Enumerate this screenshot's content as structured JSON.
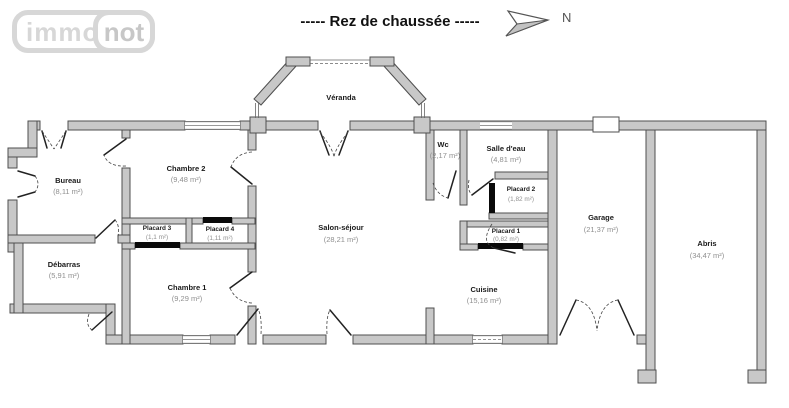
{
  "logo": {
    "immo": "immo",
    "not": "not"
  },
  "header": {
    "title": "-----  Rez de chaussée  -----",
    "north": "N"
  },
  "rooms": {
    "veranda": {
      "name": "Véranda",
      "area": ""
    },
    "bureau": {
      "name": "Bureau",
      "area": "(8,11 m²)"
    },
    "debarras": {
      "name": "Débarras",
      "area": "(5,91 m²)"
    },
    "chambre2": {
      "name": "Chambre 2",
      "area": "(9,48 m²)"
    },
    "placard3": {
      "name": "Placard 3",
      "area": "(1,1 m²)"
    },
    "placard4": {
      "name": "Placard 4",
      "area": "(1,11 m²)"
    },
    "chambre1": {
      "name": "Chambre 1",
      "area": "(9,29 m²)"
    },
    "salon": {
      "name": "Salon-séjour",
      "area": "(28,21 m²)"
    },
    "wc": {
      "name": "Wc",
      "area": "(2,17 m²)"
    },
    "salle_eau": {
      "name": "Salle d'eau",
      "area": "(4,81 m²)"
    },
    "placard2": {
      "name": "Placard 2",
      "area": "(1,82 m²)"
    },
    "placard1": {
      "name": "Placard 1",
      "area": "(0,82 m²)"
    },
    "cuisine": {
      "name": "Cuisine",
      "area": "(15,16 m²)"
    },
    "garage": {
      "name": "Garage",
      "area": "(21,37 m²)"
    },
    "abris": {
      "name": "Abris",
      "area": "(34,47 m²)"
    }
  },
  "colors": {
    "wall_fill": "#c8c8c8",
    "wall_stroke": "#4f4f4f",
    "logo_gray": "#d7d7d7",
    "label_text": "#1a1a1a",
    "area_text": "#8f8f8f"
  }
}
